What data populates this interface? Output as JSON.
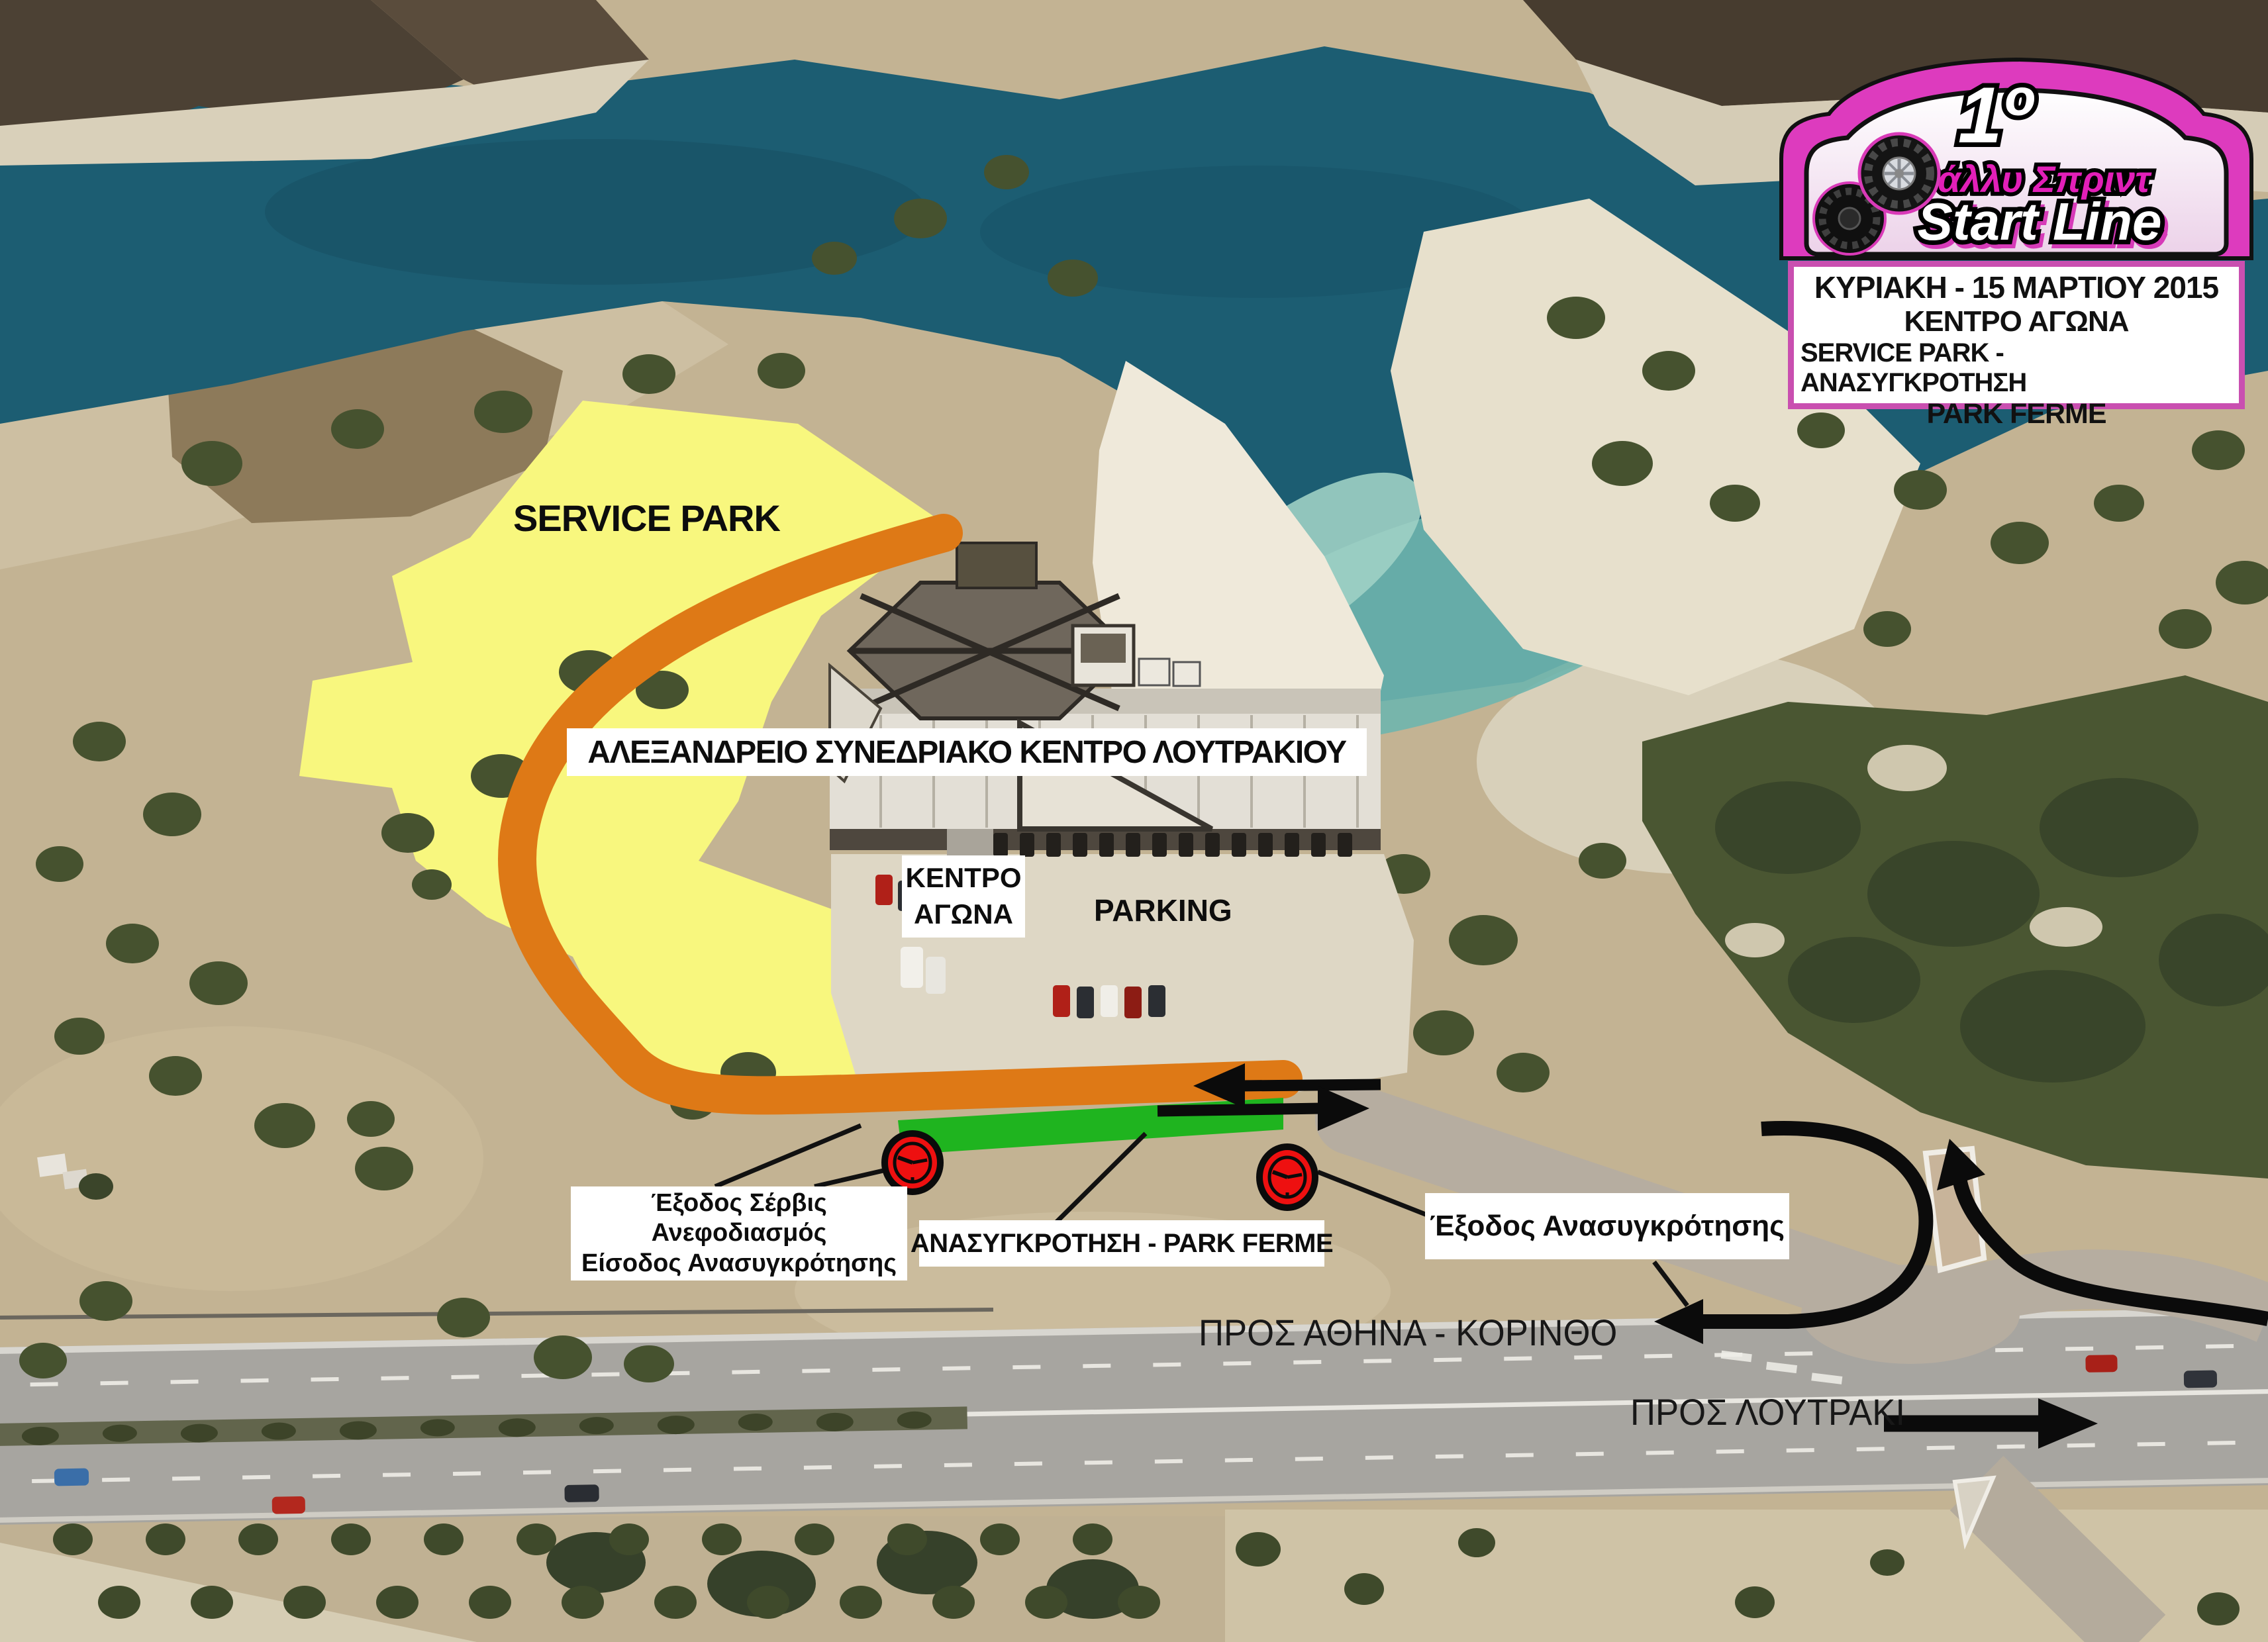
{
  "plate": {
    "number": "1º",
    "series_title": "Ράλλυ Σπριντ",
    "main_title": "Start Line"
  },
  "info_box": {
    "date": "ΚΥΡΙΑΚΗ - 15 ΜΑΡΤΙΟΥ 2015",
    "line2": "ΚΕΝΤΡΟ ΑΓΩΝΑ",
    "line3": "SERVICE PARK - ΑΝΑΣΥΓΚΡΟΤΗΣΗ",
    "line4": "PARK FERME"
  },
  "map_labels": {
    "service_park": "SERVICE PARK",
    "venue": "ΑΛΕΞΑΝΔΡΕΙΟ ΣΥΝΕΔΡΙΑΚΟ ΚΕΝΤΡΟ ΛΟΥΤΡΑΚΙΟΥ",
    "race_hq_line1": "ΚΕΝΤΡΟ",
    "race_hq_line2": "ΑΓΩΝΑ",
    "parking": "PARKING",
    "service_exit_line1": "Έξοδος Σέρβις",
    "service_exit_line2": "Ανεφοδιασμός",
    "service_exit_line3": "Είσοδος Ανασυγκρότησης",
    "regroup": "ΑΝΑΣΥΓΚΡΟΤΗΣΗ - PARK FERME",
    "regroup_exit": "Έξοδος Ανασυγκρότησης",
    "to_athens": "ΠΡΟΣ ΑΘΗΝΑ - ΚΟΡΙΝΘΟ",
    "to_loutraki": "ΠΡΟΣ ΛΟΥΤΡΑΚΙ"
  },
  "colors": {
    "service_park_zone": "#F8F77E",
    "route": "#DE7916",
    "regroup_strip": "#1FB41F",
    "time_control": "#EE1010",
    "plate_magenta": "#DD3BBE",
    "info_border": "#C94FB0",
    "water": "#1C5D72"
  }
}
